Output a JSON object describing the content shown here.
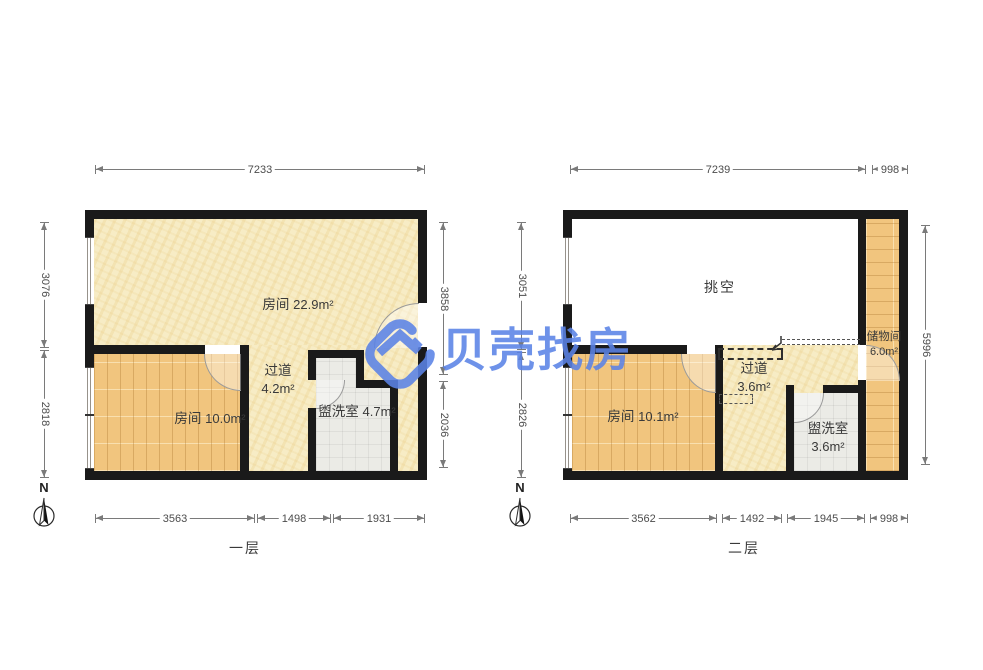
{
  "watermark": {
    "brand": "贝壳找房"
  },
  "north": "N",
  "colors": {
    "brand_blue": "#5b83e6",
    "wall": "#1a1a1a",
    "floor_cream": "#f7ecc5",
    "floor_wood": "#f1c57e",
    "floor_tile": "#ebebe6",
    "dimension_gray": "#7a7a7a"
  },
  "floor1": {
    "label": "一层",
    "rooms": [
      {
        "name": "房间",
        "area": "22.9m²"
      },
      {
        "name": "房间",
        "area": "10.0m²"
      },
      {
        "name": "过道",
        "area": "4.2m²"
      },
      {
        "name": "盥洗室",
        "area": "4.7m²"
      }
    ],
    "dims": {
      "top": [
        "7233"
      ],
      "left": [
        "3076",
        "2818"
      ],
      "right": [
        "3858",
        "2036"
      ],
      "bottom": [
        "3563",
        "1498",
        "1931"
      ]
    }
  },
  "floor2": {
    "label": "二层",
    "rooms": [
      {
        "name": "挑空",
        "area": ""
      },
      {
        "name": "房间",
        "area": "10.1m²"
      },
      {
        "name": "过道",
        "area": "3.6m²"
      },
      {
        "name": "盥洗室",
        "area": "3.6m²"
      },
      {
        "name": "储物间",
        "area": "6.0m²"
      }
    ],
    "dims": {
      "top": [
        "7239",
        "998"
      ],
      "left": [
        "3051",
        "2826"
      ],
      "right": [
        "5996"
      ],
      "bottom": [
        "3562",
        "1492",
        "1945",
        "998"
      ]
    }
  }
}
